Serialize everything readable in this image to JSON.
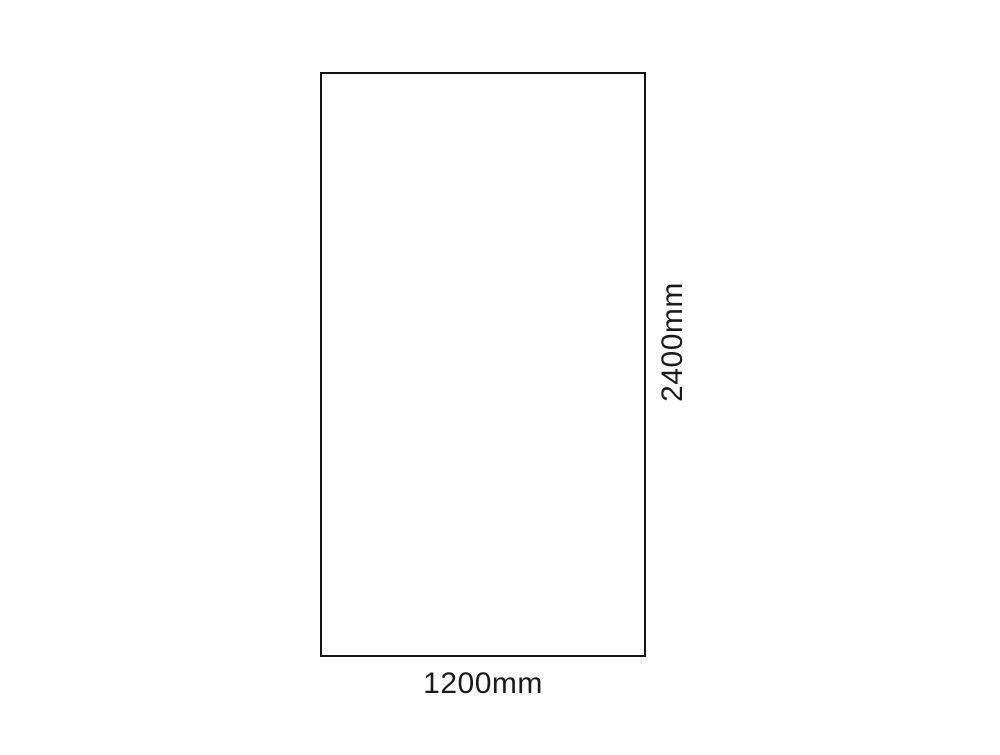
{
  "diagram": {
    "type": "dimension-drawing",
    "shape": "rectangle",
    "labels": {
      "width": "1200mm",
      "height": "2400mm"
    },
    "dimensions_mm": {
      "width": 1200,
      "height": 2400
    },
    "colors": {
      "background": "#ffffff",
      "rectangle_fill": "#ffffff",
      "rectangle_border": "#141414",
      "text": "#1a1a1a"
    }
  }
}
